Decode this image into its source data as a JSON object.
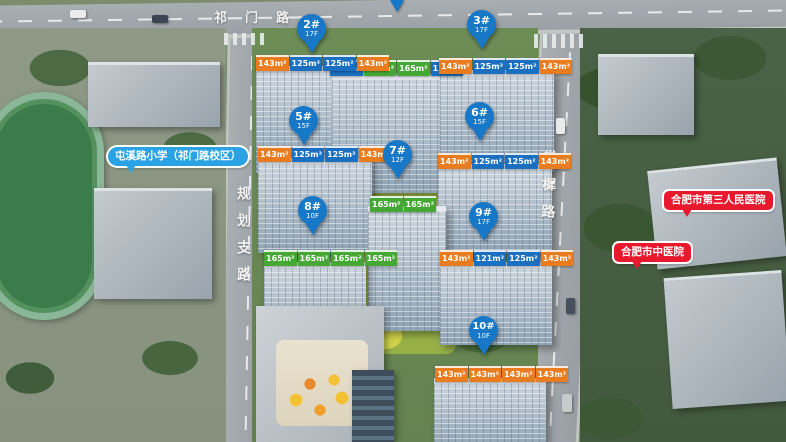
{
  "scene": {
    "description": "aerial master-plan rendering of residential development"
  },
  "roads": {
    "top": "祁门路",
    "left": "规划支路",
    "right": "棠樨路"
  },
  "landmarks": {
    "school": "屯溪路小学（祁门路校区）",
    "hospital_third": "合肥市第三人民医院",
    "hospital_tcm": "合肥市中医院"
  },
  "pins": {
    "b2": {
      "name": "2#",
      "floors": "17F"
    },
    "b3": {
      "name": "3#",
      "floors": "17F"
    },
    "b5": {
      "name": "5#",
      "floors": "15F"
    },
    "b6": {
      "name": "6#",
      "floors": "15F"
    },
    "b7": {
      "name": "7#",
      "floors": "12F"
    },
    "b8": {
      "name": "8#",
      "floors": "10F"
    },
    "b9": {
      "name": "9#",
      "floors": "17F"
    },
    "b10": {
      "name": "10#",
      "floors": "10F"
    }
  },
  "area_labels": {
    "b1": [
      "125m²",
      "165m²",
      "165m²",
      "125m²"
    ],
    "b2": [
      "143m²",
      "125m²",
      "125m²",
      "143m²"
    ],
    "b3": [
      "143m²",
      "125m²",
      "125m²",
      "143m²"
    ],
    "b5": [
      "143m²",
      "125m²",
      "125m²",
      "143m²"
    ],
    "b6": [
      "143m²",
      "125m²",
      "125m²",
      "143m²"
    ],
    "b7": [
      "165m²",
      "165m²"
    ],
    "b8": [
      "165m²",
      "165m²",
      "165m²",
      "165m²"
    ],
    "b9": [
      "143m²",
      "121m²",
      "125m²",
      "143m²"
    ],
    "b10": [
      "143m²",
      "143m²",
      "143m²",
      "143m²"
    ]
  },
  "colors": {
    "pin_blue": "#1778c8",
    "label_blue": "#1b6fc0",
    "label_green": "#45a835",
    "label_orange": "#e87c1e",
    "bubble_red": "#e8192c",
    "bubble_blue": "#29a3e3",
    "road_gray": "#a0a6ab",
    "park_green": "#a5bd4e"
  }
}
